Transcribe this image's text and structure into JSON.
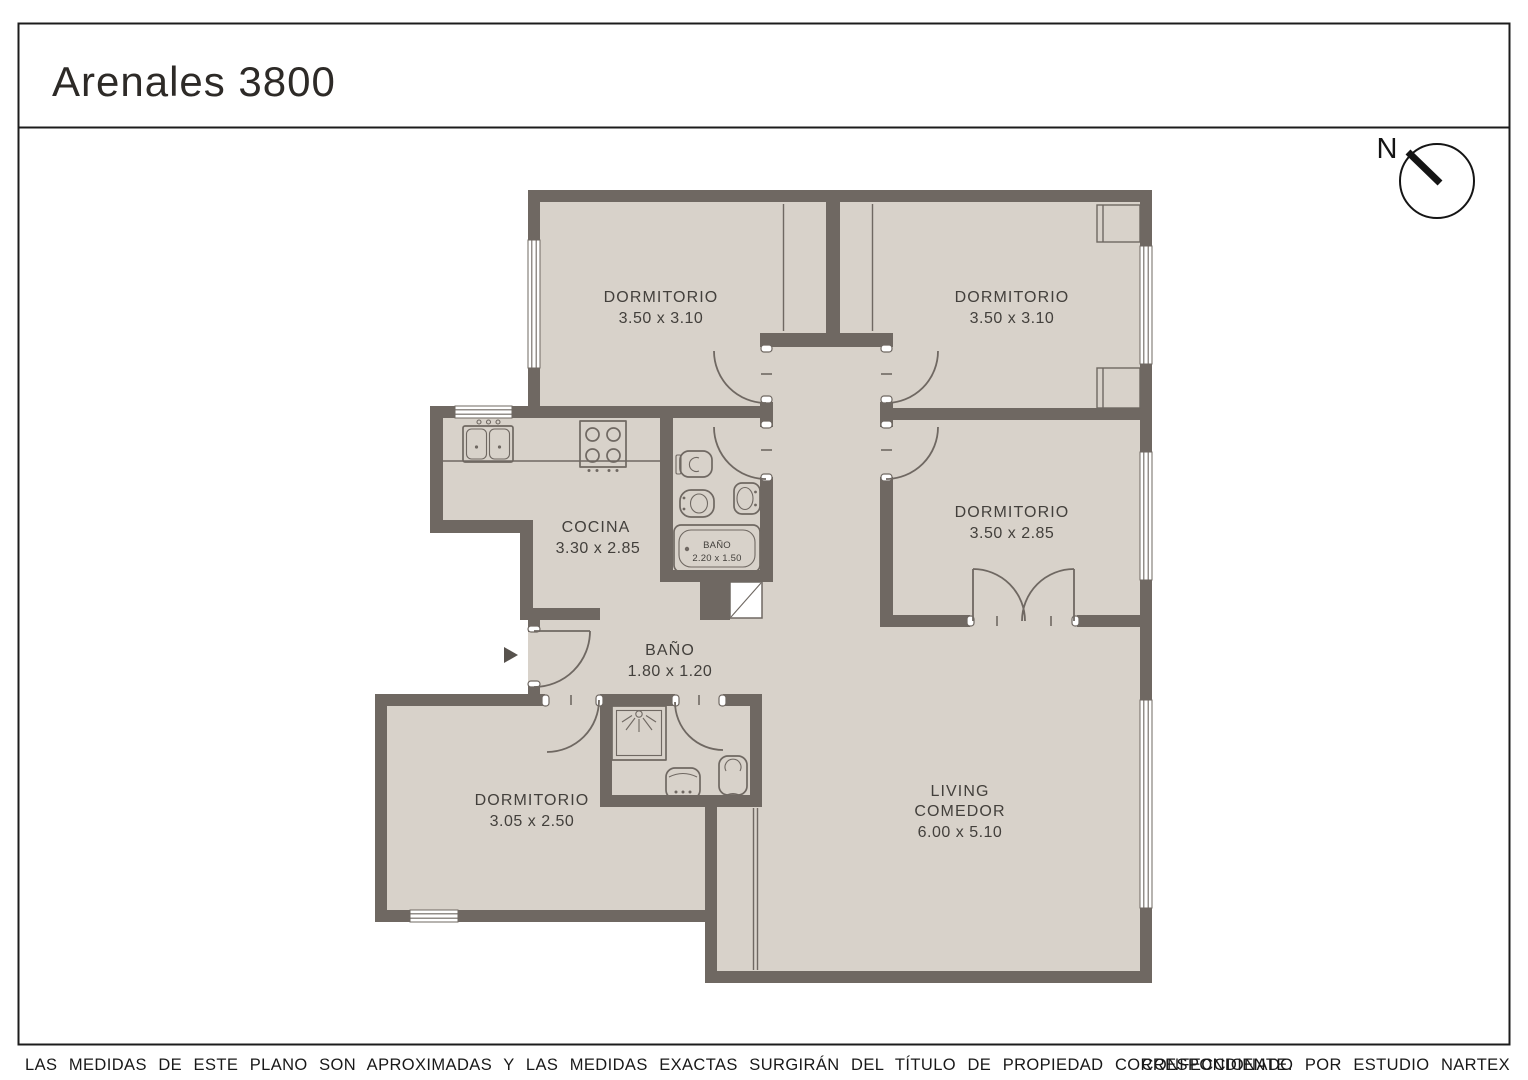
{
  "title": "Arenales 3800",
  "compass": {
    "label": "N"
  },
  "rooms": {
    "bedroom1": {
      "name": "DORMITORIO",
      "dims": "3.50 x 3.10"
    },
    "bedroom2": {
      "name": "DORMITORIO",
      "dims": "3.50 x 3.10"
    },
    "bedroom3": {
      "name": "DORMITORIO",
      "dims": "3.50 x  2.85"
    },
    "kitchen": {
      "name": "COCINA",
      "dims": "3.30 x 2.85"
    },
    "bathroom_small": {
      "name": "BAÑO",
      "dims": "2.20 x 1.50"
    },
    "bathroom_hall": {
      "name": "BAÑO",
      "dims": "1.80 x 1.20"
    },
    "bedroom4": {
      "name": "DORMITORIO",
      "dims": "3.05 x 2.50"
    },
    "living": {
      "name_line1": "LIVING",
      "name_line2": "COMEDOR",
      "dims": "6.00 x 5.10"
    }
  },
  "footer": {
    "disclaimer": "LAS MEDIDAS  DE ESTE PLANO SON APROXIMADAS Y LAS MEDIDAS EXACTAS SURGIRÁN DEL TÍTULO DE PROPIEDAD CORRESPONDIENTE.",
    "credit": "CONFECCIONADO POR ESTUDIO NARTEX"
  },
  "colors": {
    "wall": "#6f6862",
    "floor": "#d8d2ca",
    "line": "#1c1c1c"
  }
}
